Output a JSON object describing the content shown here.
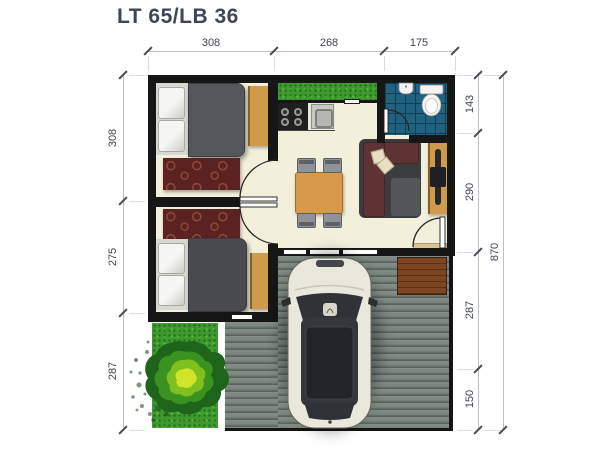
{
  "title": "LT 65/LB 36",
  "dimensions": {
    "top": [
      "308",
      "268",
      "175"
    ],
    "left": [
      "308",
      "275",
      "287"
    ],
    "right": [
      "143",
      "290",
      "287",
      "150"
    ],
    "overall": "870"
  },
  "colors": {
    "wall": "#161616",
    "floor": "#f2efdb",
    "deck": "#6e7972",
    "wood_accent": "#cf9a49",
    "bathroom_tile": "#20617f",
    "grass": "#3c9a2e",
    "rug": "#5a2321",
    "sofa": "#5f3234",
    "bed_blanket": "#54575b",
    "car_body": "#eae8dd",
    "dimension_text": "#3b4550"
  }
}
